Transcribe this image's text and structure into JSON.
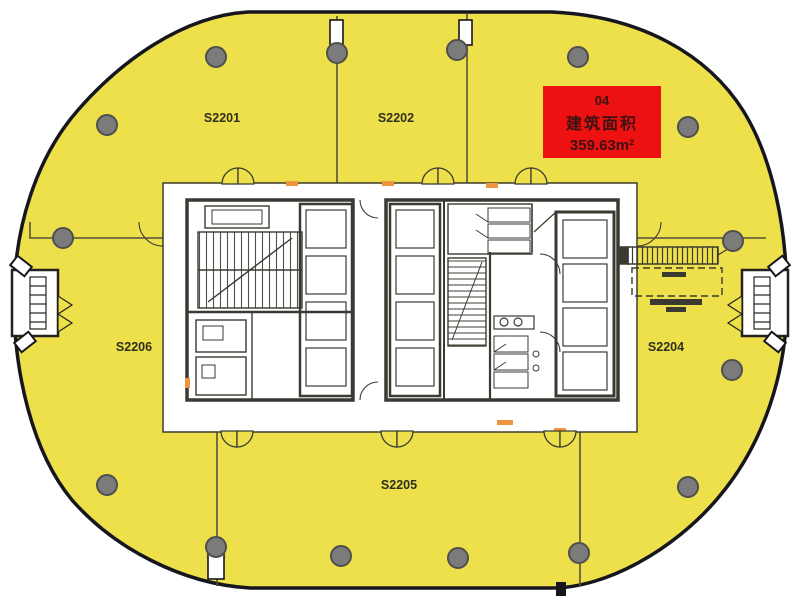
{
  "colors": {
    "canvas_bg": "#ffffff",
    "plate": "#ede04b",
    "outline": "#16161e",
    "wall": "#3a3a32",
    "partition": "#55503a",
    "column_fill": "#7b7b7b",
    "column_stroke": "#4f4f4f",
    "door_mark": "#f0953f",
    "highlight_bg": "#ee1111",
    "highlight_text": "#3a1212",
    "unit_label": "#2f2f1f"
  },
  "units": [
    {
      "label": "S2201"
    },
    {
      "label": "S2202"
    },
    {
      "label": "S2204"
    },
    {
      "label": "S2205"
    },
    {
      "label": "S2206"
    }
  ],
  "highlight": {
    "unit_no": "04",
    "area_label": "建筑面积",
    "area_value": "359.63m²"
  }
}
